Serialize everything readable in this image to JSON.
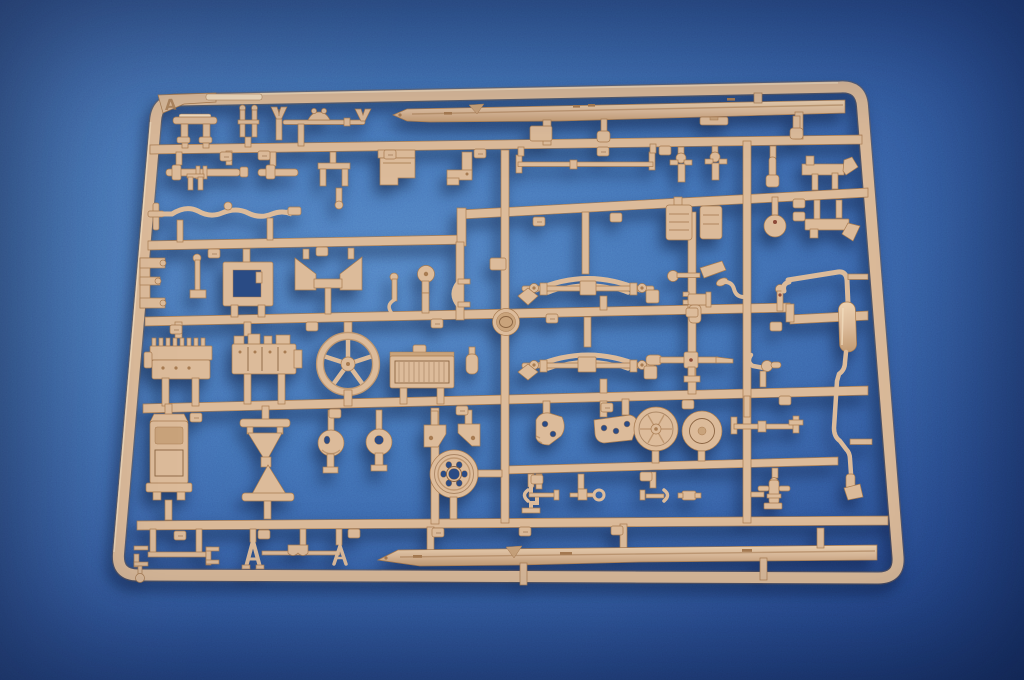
{
  "photo": {
    "subject": "Injection-molded tan plastic model kit sprue of vehicle chassis parts photographed on blue textured paper",
    "sprue_letter": "A"
  },
  "colors": {
    "bg-light": "#4e7bc0",
    "bg-mid": "#3d69ae",
    "bg-deep": "#2a4d8f",
    "bg-corner": "#1d3a72",
    "plastic": "#dcbb9a",
    "plastic-light": "#f2dcbe",
    "plastic-mid": "#c9a37b",
    "plastic-dark": "#a87c52",
    "plastic-line": "#8a6442",
    "hole": "#2a4b84",
    "accent-dot": "#8c4a38"
  }
}
